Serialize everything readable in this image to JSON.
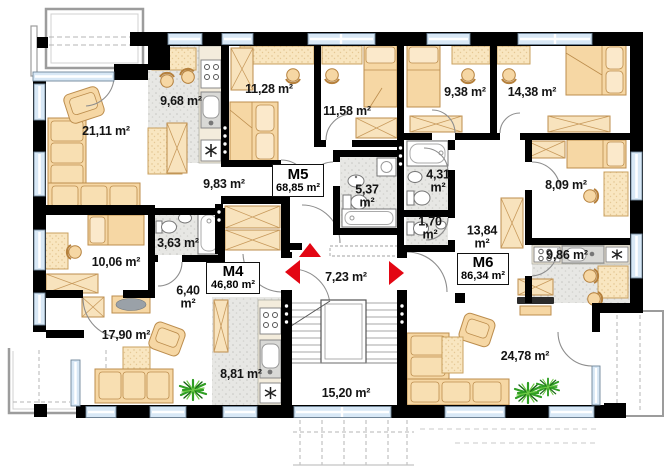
{
  "plan_title": "Floor plan with apartments",
  "apartments": [
    {
      "name": "M4",
      "area": "46,80 m²"
    },
    {
      "name": "M5",
      "area": "68,85 m²"
    },
    {
      "name": "M6",
      "area": "86,34 m²"
    }
  ],
  "rooms": [
    {
      "id": "living-m5",
      "label": "21,11 m²"
    },
    {
      "id": "kitchen-m5",
      "label": "9,68 m²"
    },
    {
      "id": "bedroom1-m5",
      "label": "11,28 m²"
    },
    {
      "id": "bedroom2-m5",
      "label": "11,58 m²"
    },
    {
      "id": "bedroom1-m6",
      "label": "9,38 m²"
    },
    {
      "id": "bedroom2-m6",
      "label": "14,38 m²"
    },
    {
      "id": "hall-m5",
      "label": "9,83 m²"
    },
    {
      "id": "bathroom-m5",
      "label": "5,37 m²"
    },
    {
      "id": "bathroom-m6",
      "label": "4,31 m²"
    },
    {
      "id": "wc-m6",
      "label": "1,70 m²"
    },
    {
      "id": "hall-m6",
      "label": "13,84 m²"
    },
    {
      "id": "bedroom3-m6",
      "label": "8,09 m²"
    },
    {
      "id": "bathroom-m4",
      "label": "3,63 m²"
    },
    {
      "id": "bedroom-m4",
      "label": "10,06 m²"
    },
    {
      "id": "hall-m4",
      "label": "6,40 m²"
    },
    {
      "id": "entrance-hall",
      "label": "7,23 m²"
    },
    {
      "id": "living-m4",
      "label": "17,90 m²"
    },
    {
      "id": "kitchen-m4",
      "label": "8,81 m²"
    },
    {
      "id": "staircase",
      "label": "15,20 m²"
    },
    {
      "id": "living-m6",
      "label": "24,78 m²"
    },
    {
      "id": "kitchen-m6",
      "label": "9,86 m²"
    }
  ],
  "icons": {
    "fridge": "snowflake",
    "entrance_marker": "red-triangle"
  },
  "colors": {
    "wall": "#000000",
    "window": "#d8e8f6",
    "furniture": "#f6d7a4",
    "furniture_border": "#bc8d4d",
    "wet_floor": "#e7e7e4",
    "accent_red": "#e30613",
    "plant_green": "#2f9e23"
  }
}
